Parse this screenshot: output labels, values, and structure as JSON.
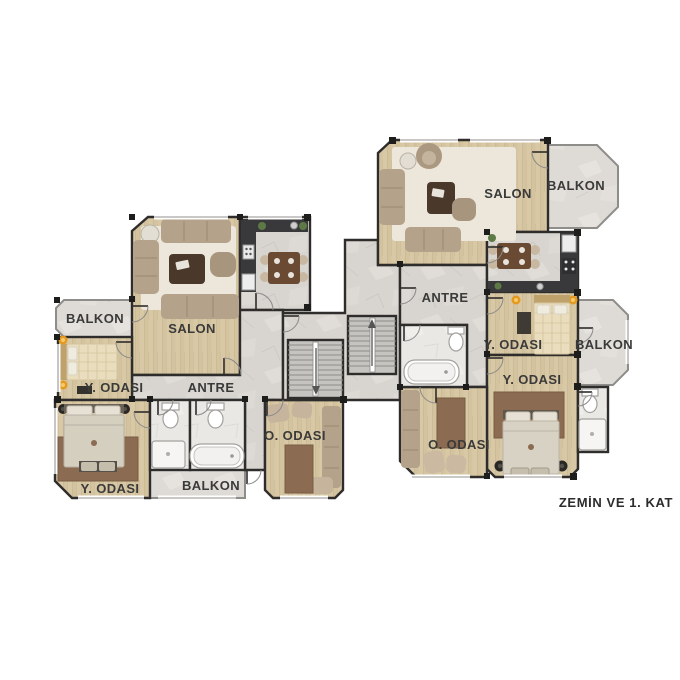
{
  "floor_title": "ZEMİN VE 1. KAT",
  "left_unit": {
    "balcony_left": "BALKON",
    "bedroom_upper": "Y. ODASI",
    "salon": "SALON",
    "antre": "ANTRE",
    "bedroom_lower": "Y. ODASI",
    "balcony_bottom": "BALKON",
    "sitting_room": "O. ODASI"
  },
  "right_unit": {
    "salon": "SALON",
    "balcony_top": "BALKON",
    "antre": "ANTRE",
    "bedroom_upper": "Y. ODASI",
    "balcony_right": "BALKON",
    "bedroom_lower": "Y. ODASI",
    "sitting_room": "O. ODASI"
  },
  "colors": {
    "wood_floor": "#d8c8a5",
    "marble_floor": "#d8d5d0",
    "balcony_floor": "#dedbd6",
    "bath_floor": "#eae8e5",
    "wall": "#2e2d2b",
    "counter_dark": "#39393b",
    "sofa_tan": "#b5a28b",
    "rug_light": "#ece6db",
    "rug_brown": "#8b6b51",
    "bed_cream": "#e9ddbd",
    "lamp_orange": "#e59a1f",
    "stair_gray": "#c6c4c1",
    "label_text": "#3a3a3a"
  }
}
